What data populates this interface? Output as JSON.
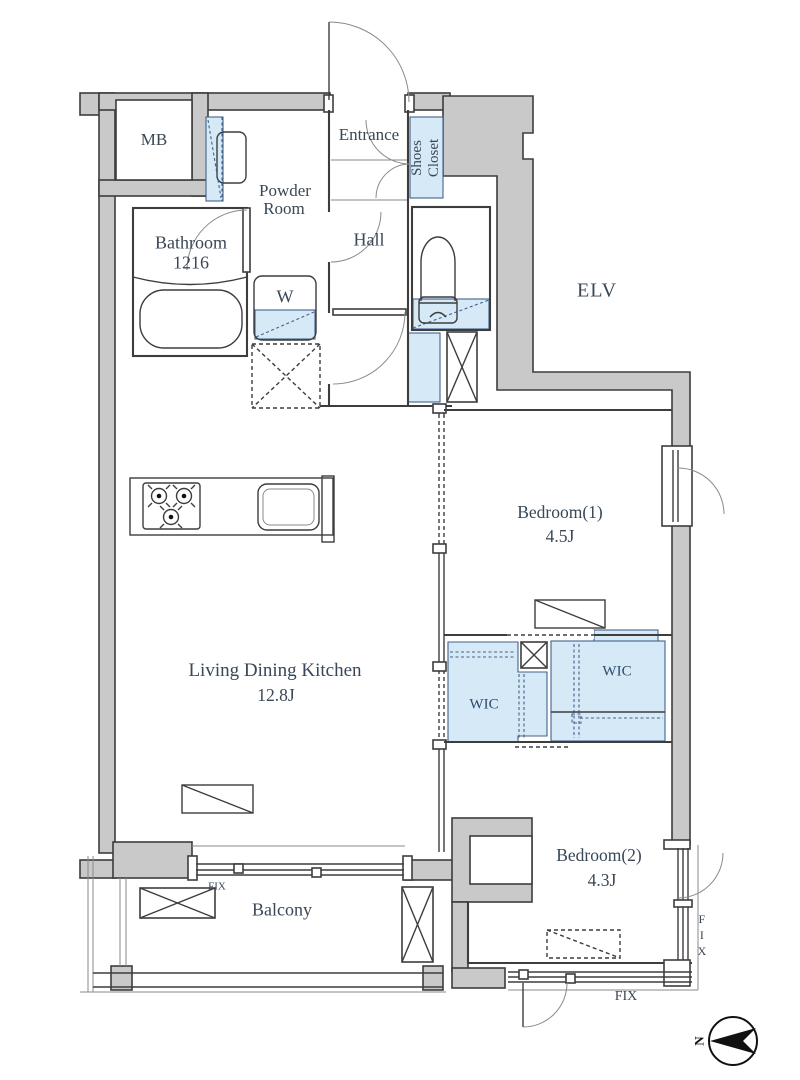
{
  "colors": {
    "wall_gray": "#c9c9c9",
    "outline": "#3d3d3d",
    "closet_blue": "#d5e9f7",
    "text": "#394756"
  },
  "rooms": {
    "mb": {
      "label": "MB"
    },
    "powder_room": {
      "line1": "Powder",
      "line2": "Room"
    },
    "entrance": {
      "label": "Entrance"
    },
    "shoes_closet": {
      "line1": "Shoes",
      "line2": "Closet"
    },
    "bathroom": {
      "name": "Bathroom",
      "size": "1216"
    },
    "hall": {
      "label": "Hall"
    },
    "washer": {
      "label": "W"
    },
    "elevator": {
      "label": "ELV"
    },
    "bedroom1": {
      "name": "Bedroom(1)",
      "area": "4.5J"
    },
    "wic_left": {
      "label": "WIC"
    },
    "wic_right": {
      "label": "WIC"
    },
    "ldk": {
      "name": "Living Dining Kitchen",
      "area": "12.8J"
    },
    "bedroom2": {
      "name": "Bedroom(2)",
      "area": "4.3J"
    },
    "balcony": {
      "label": "Balcony"
    }
  },
  "annotations": {
    "fix_balcony": "FIX",
    "fix_east": "FIX",
    "fix_south": "FIX",
    "compass_north": "N"
  }
}
